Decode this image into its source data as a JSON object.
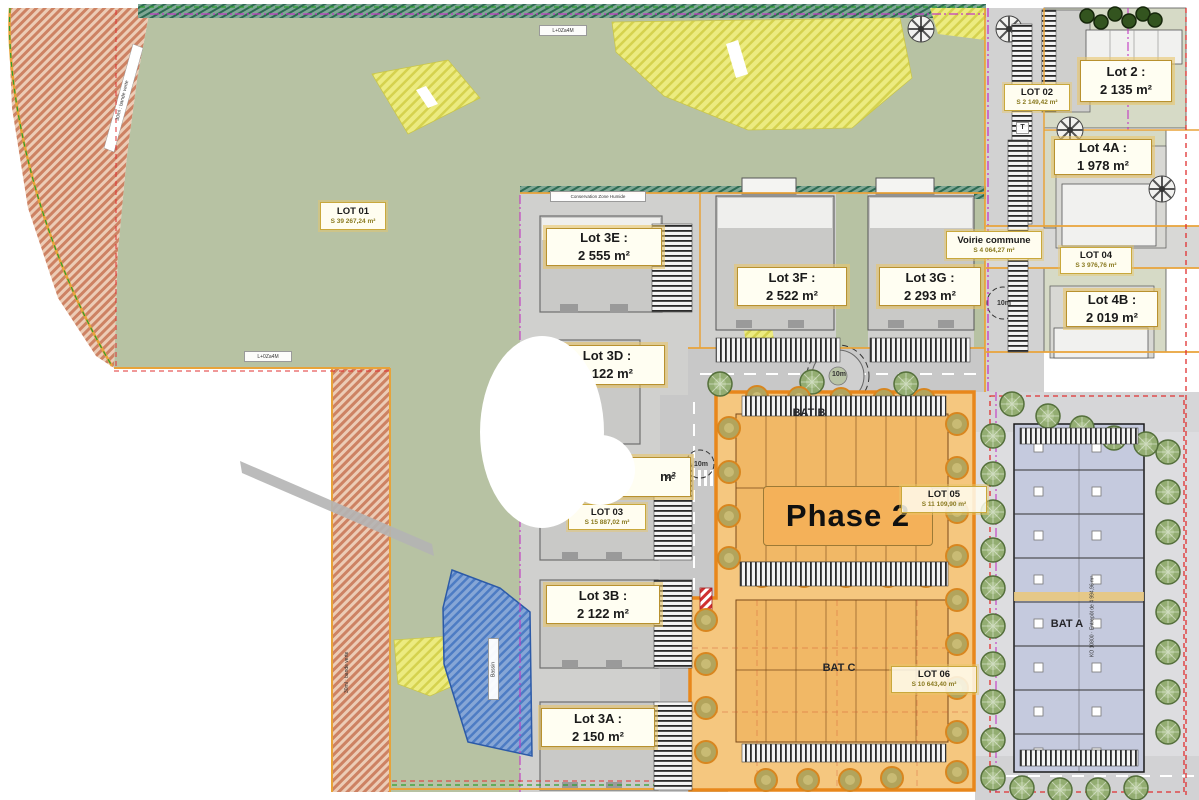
{
  "colors": {
    "green_zone": "#b7c2a3",
    "grey_pad": "#d0d0ce",
    "road": "#c8c8c8",
    "phase2_fill": "#f5c77f",
    "phase2_border": "#e8871b",
    "phase2_box": "#f4b159",
    "yellow_patch": "#eceb80",
    "red_hatch": "#cd8263",
    "pond_blue": "#4d7cc4",
    "label_border": "#e9c76a",
    "bat_a_fill": "#c5cade"
  },
  "lots": {
    "lot01": {
      "title": "LOT 01",
      "area": "S 39 267,24 m²"
    },
    "lot02": {
      "title": "LOT 02",
      "area": "S 2 149,42 m²"
    },
    "lot03": {
      "title": "LOT 03",
      "area": "S 15 887,02 m²"
    },
    "lot04": {
      "title": "LOT 04",
      "area": "S 3 976,76 m²"
    },
    "lot05": {
      "title": "LOT 05",
      "area": "S 11 109,90 m²"
    },
    "lot06": {
      "title": "LOT 06",
      "area": "S 10 643,40 m²"
    },
    "lot2": {
      "title": "Lot 2 :",
      "area": "2 135 m²"
    },
    "lot4a": {
      "title": "Lot 4A :",
      "area": "1 978 m²"
    },
    "lot4b": {
      "title": "Lot 4B :",
      "area": "2 019 m²"
    },
    "lot3a": {
      "title": "Lot 3A :",
      "area": "2 150 m²"
    },
    "lot3b": {
      "title": "Lot 3B :",
      "area": "2 122 m²"
    },
    "lot3c_partial": "m²",
    "lot3d": {
      "title": "Lot 3D :",
      "area": "2 122 m²"
    },
    "lot3e": {
      "title": "Lot 3E :",
      "area": "2 555 m²"
    },
    "lot3f": {
      "title": "Lot 3F :",
      "area": "2 522 m²"
    },
    "lot3g": {
      "title": "Lot 3G :",
      "area": "2 293 m²"
    }
  },
  "roads": {
    "voirie_commune": {
      "title": "Voirie commune",
      "area": "S 4 064,27 m²"
    }
  },
  "phase": {
    "label": "Phase 2"
  },
  "buildings": {
    "bat_a": "BAT A",
    "bat_b": "BAT B",
    "bat_c": "BAT C",
    "bat_a_side": "KO 10800 · Entrepôt de 4 994,96 m²"
  },
  "annotations": {
    "conservation": "Conservation Zone Humide",
    "marker_top": "L+0Za4M",
    "marker_mid": "L+0Za4M",
    "band_left": "30ml : bande verte",
    "band_bottom": "30ml : bande verte",
    "pond": "Bassin",
    "t_marker": "T",
    "pc_marker": "PC",
    "dim_10m": "10m"
  }
}
